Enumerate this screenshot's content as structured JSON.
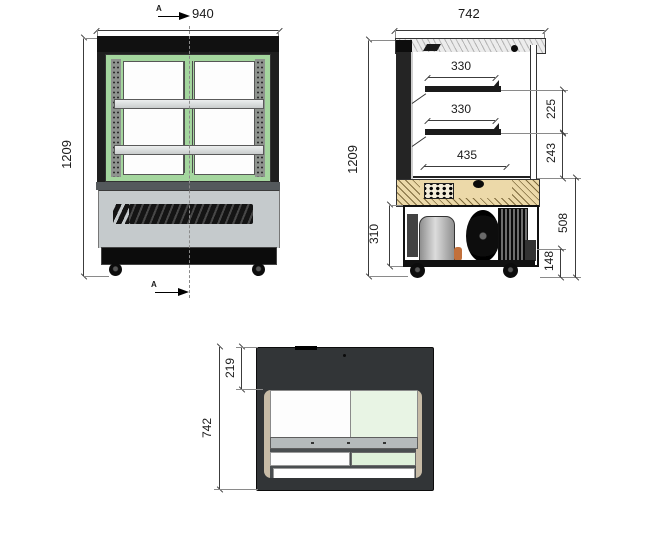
{
  "drawing": {
    "front_view": {
      "width_label": "940",
      "height_label": "1209",
      "section_marker_top": "A",
      "section_marker_bottom": "A"
    },
    "side_view": {
      "width_label": "742",
      "height_label": "1209",
      "shelf_top_depth": "330",
      "shelf_middle_depth": "330",
      "deck_depth": "435",
      "gap_top_shelf": "225",
      "gap_middle_shelf": "243",
      "machine_compartment_height": "310",
      "base_section_height": "508",
      "caster_height": "148"
    },
    "top_view": {
      "front_margin_label": "219",
      "depth_label": "742"
    },
    "colors": {
      "frame_green": "#a4d69e",
      "glass_tint_green": "#e8f4e4",
      "wood_tan": "#ecd9a9",
      "body_dark": "#1e1e1e",
      "base_gray": "#c5cacc"
    }
  }
}
